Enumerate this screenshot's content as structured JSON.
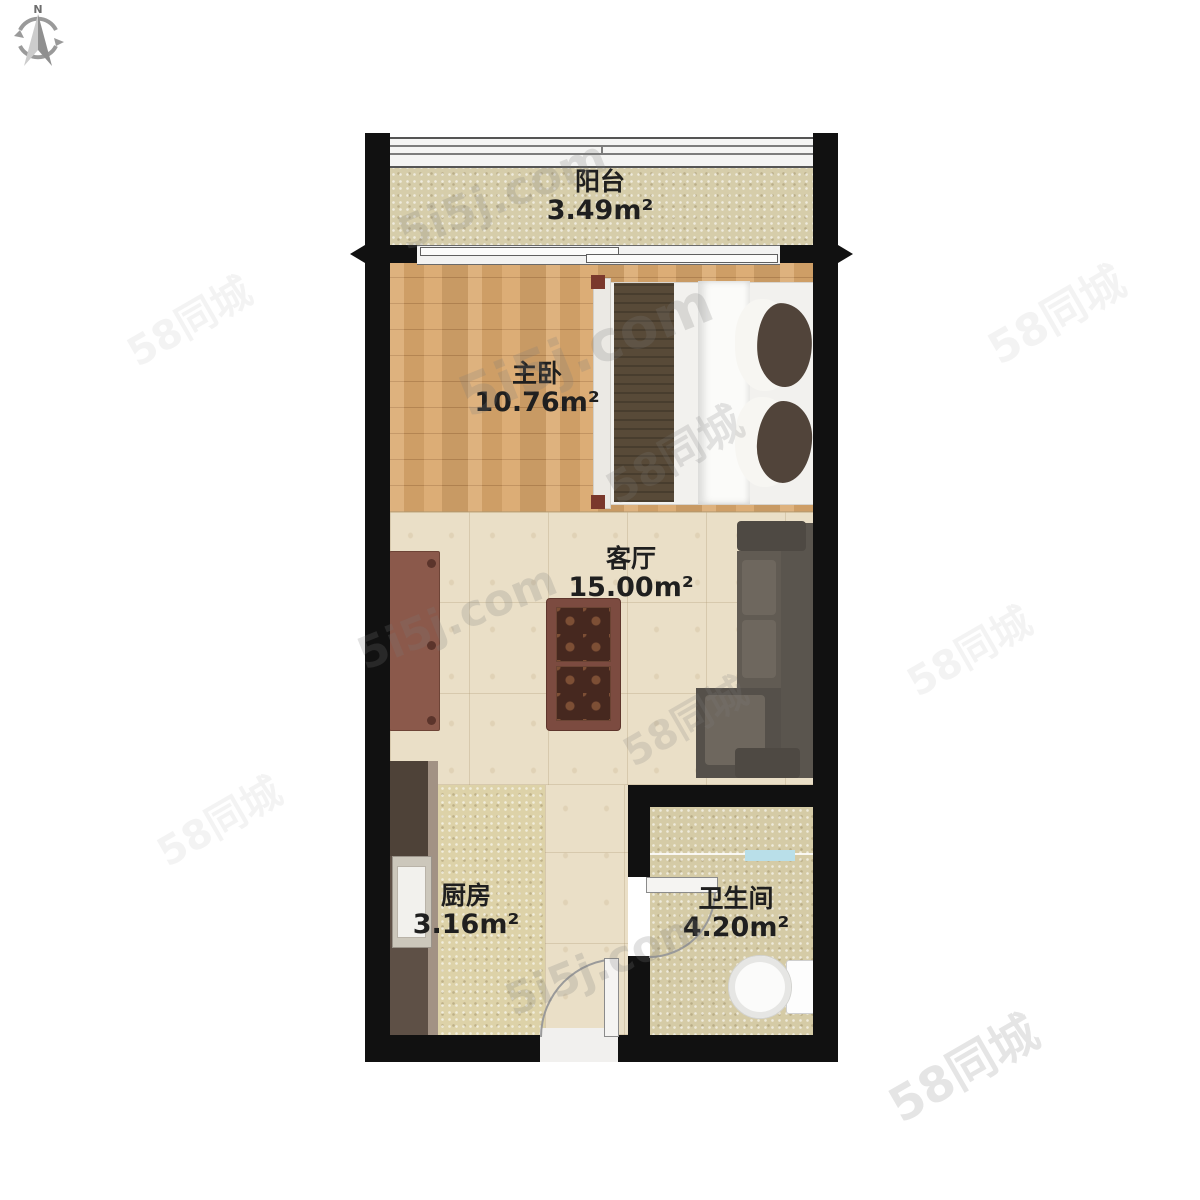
{
  "compass": {
    "label": "N"
  },
  "rooms": {
    "balcony": {
      "name": "阳台",
      "area": "3.49m²"
    },
    "bedroom": {
      "name": "主卧",
      "area": "10.76m²"
    },
    "living": {
      "name": "客厅",
      "area": "15.00m²"
    },
    "kitchen": {
      "name": "厨房",
      "area": "3.16m²"
    },
    "bathroom": {
      "name": "卫生间",
      "area": "4.20m²"
    }
  },
  "watermarks": {
    "brand_a": "5i5j.com",
    "brand_b": "58同城"
  },
  "colors": {
    "wall": "#111111",
    "wood_floor": "#d9a76c",
    "marble_floor": "#eadfc7",
    "balcony_floor": "#d6cdaa",
    "kitchen_floor": "#ddd2a8",
    "bath_floor": "#d5cba6",
    "sofa": "#57514a",
    "bed_blanket": "#584a38",
    "tv_cabinet": "#8b594b",
    "coffee_table": "#7c4b40",
    "kitchen_counter": "#5e5046"
  }
}
